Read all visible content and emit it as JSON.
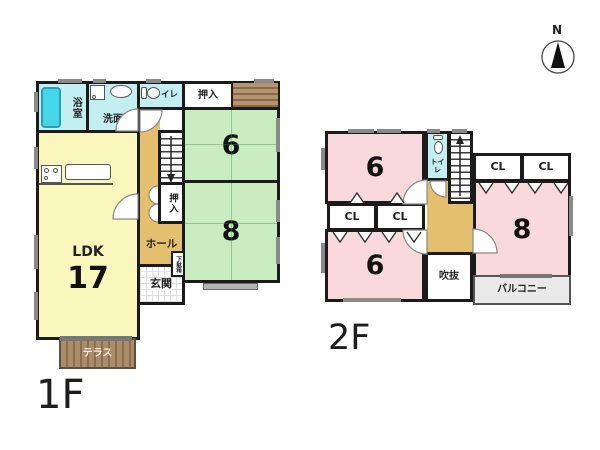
{
  "compass": {
    "label": "N"
  },
  "floor1": {
    "label": "1F",
    "rooms": {
      "bath": "浴室",
      "washroom": "洗面",
      "toilet": "トイレ",
      "closet_top": "押入",
      "tatami6": "6",
      "tatami8": "8",
      "closet_stairs": "押入",
      "hall": "ホール",
      "shoe_cabinet": "下駄箱",
      "entrance": "玄関",
      "ldk_label": "LDK",
      "ldk_size": "17",
      "terrace": "テラス"
    }
  },
  "floor2": {
    "label": "2F",
    "rooms": {
      "room6_front": "6",
      "room6_rear": "6",
      "room8": "8",
      "toilet": "トイレ",
      "closet_1": "CL",
      "closet_2": "CL",
      "closet_3": "CL",
      "closet_4": "CL",
      "void": "吹抜",
      "balcony": "バルコニー"
    }
  },
  "palette": {
    "wall": "#1b1b1b",
    "ldk": "#faf7bd",
    "tatami": "#c9ecc0",
    "western": "#f9d9dc",
    "wet": "#c3eff3",
    "tub": "#45d6e8",
    "hall": "#e4c06e",
    "terrace": "#ab8c68",
    "terrace-stripe": "#8a6e4e",
    "balcony": "#e9e9e9",
    "window": "#8a8a8a"
  }
}
